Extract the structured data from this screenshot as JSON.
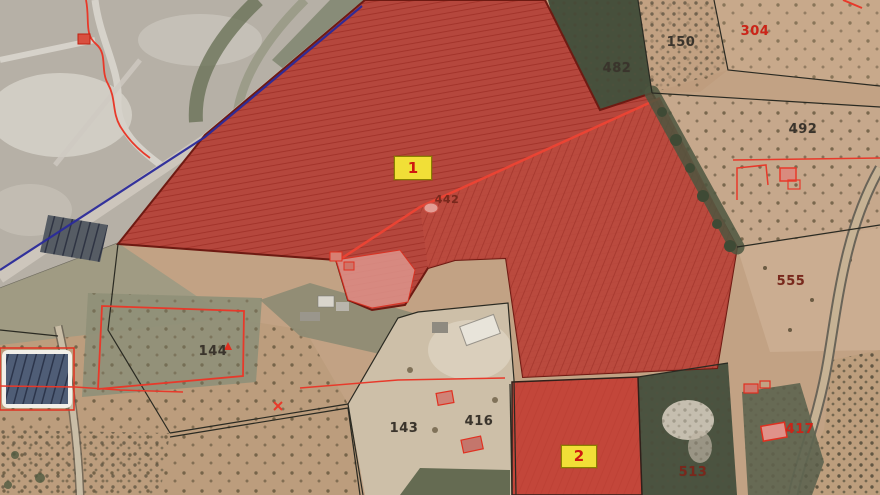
{
  "map": {
    "selection_markers": [
      {
        "text": "1"
      },
      {
        "text": "2"
      }
    ],
    "parcel_numbers": [
      {
        "text": "482",
        "style": "dark"
      },
      {
        "text": "150",
        "style": "dark"
      },
      {
        "text": "304",
        "style": "red"
      },
      {
        "text": "492",
        "style": "dark"
      },
      {
        "text": "555",
        "style": "maroon"
      },
      {
        "text": "144",
        "style": "dark"
      },
      {
        "text": "143",
        "style": "dark"
      },
      {
        "text": "416",
        "style": "dark"
      },
      {
        "text": "442",
        "style": "maroon"
      },
      {
        "text": "513",
        "style": "maroon"
      },
      {
        "text": "417",
        "style": "red"
      }
    ],
    "colors": {
      "selection_overlay": "#b5473d",
      "selection_overlay_bright": "#c64438",
      "marker_bg": "#f1df37",
      "marker_text": "#cf1810",
      "cadastral_line_red": "#e8392a",
      "boundary_black": "#2a2a22",
      "road_line_blue": "#2a2a9a",
      "terrain_tan": "#c2a284",
      "quarry_gray": "#b6b0a6",
      "forest_green": "#4b5340"
    }
  }
}
